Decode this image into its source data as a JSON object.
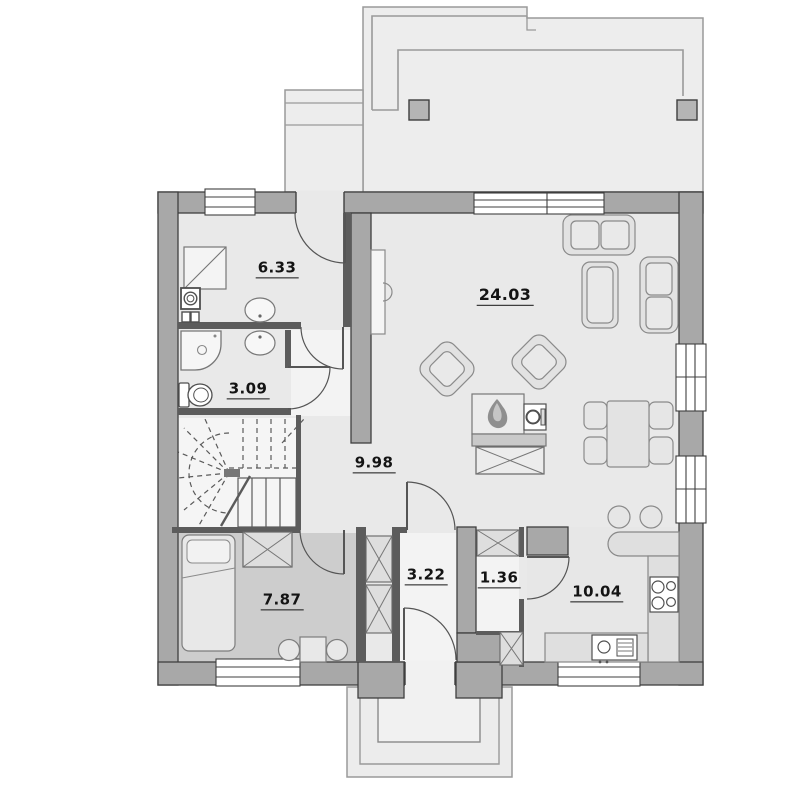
{
  "plan": {
    "title": "house-ground-floor-plan",
    "rooms": [
      {
        "id": "utility-room",
        "area": "6.33"
      },
      {
        "id": "bathroom",
        "area": "3.09"
      },
      {
        "id": "living-room",
        "area": "24.03"
      },
      {
        "id": "hall",
        "area": "9.98"
      },
      {
        "id": "bedroom",
        "area": "7.87"
      },
      {
        "id": "vestibule",
        "area": "3.22"
      },
      {
        "id": "pantry",
        "area": "1.36"
      },
      {
        "id": "kitchen",
        "area": "10.04"
      }
    ],
    "colors": {
      "wallFill": "#a8a8a8",
      "wallEdge": "#3f3f3f",
      "partition": "#5c5c5c",
      "floorBase": "#e9e9e9",
      "floorBedroom": "#cdcdcd",
      "floorLight": "#f3f3f3",
      "floorKitchen": "#e7e7e7",
      "terraceFill": "#ededed",
      "terraceLine": "#9a9a9a",
      "furnFill": "#e2e2e2",
      "furnLine": "#8a8a8a",
      "fixtureLine": "#4f4f4f",
      "counterFill": "#dfdfdf",
      "flame": "#8f8f8f",
      "labelColor": "#141414"
    }
  }
}
